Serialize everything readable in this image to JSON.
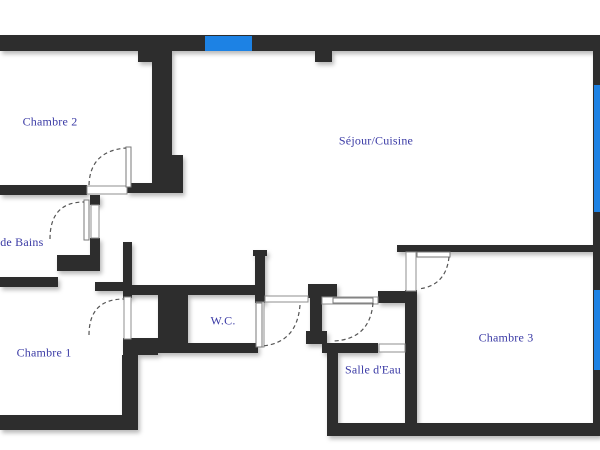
{
  "plan": {
    "title": "Apartment floor plan",
    "rooms": [
      {
        "id": "chambre2",
        "label": "Chambre 2"
      },
      {
        "id": "sejour_cuisine",
        "label": "Séjour/Cuisine"
      },
      {
        "id": "salle_de_bains",
        "label": "Salle de Bains"
      },
      {
        "id": "chambre1",
        "label": "Chambre 1"
      },
      {
        "id": "wc",
        "label": "W.C."
      },
      {
        "id": "salle_eau",
        "label": "Salle d'Eau"
      },
      {
        "id": "chambre3",
        "label": "Chambre 3"
      }
    ],
    "colors": {
      "wall": "#2d2d2d",
      "window": "#1d82e4",
      "label": "#3a3aa5",
      "background": "#ffffff"
    }
  }
}
